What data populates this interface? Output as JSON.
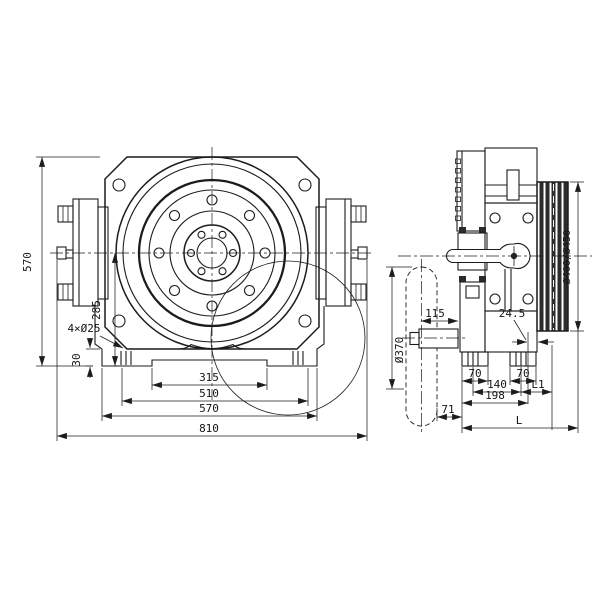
{
  "drawing": {
    "line_color": "#1c1c1c",
    "front_view": {
      "dim_total_height": "570",
      "dim_axis_to_base": "285",
      "dim_foot_height": "30",
      "dim_mounting_holes": "4×Ø25",
      "dim_feet_inner_span": "315",
      "dim_slot_span": "510",
      "dim_base_width": "570",
      "dim_overall_width": "810"
    },
    "side_view": {
      "dim_handwheel_dia": "Ø370",
      "dim_axis_offset": "115",
      "dim_groove_offset": "24.5",
      "dim_sheave_dia": "Ø400/Ø450",
      "dim_front_foot": "70",
      "dim_rear_foot": "70",
      "dim_slot_centers": "140",
      "dim_l1": "L1",
      "dim_base_length": "198",
      "dim_overhang": "71",
      "dim_overall_length": "L"
    }
  }
}
